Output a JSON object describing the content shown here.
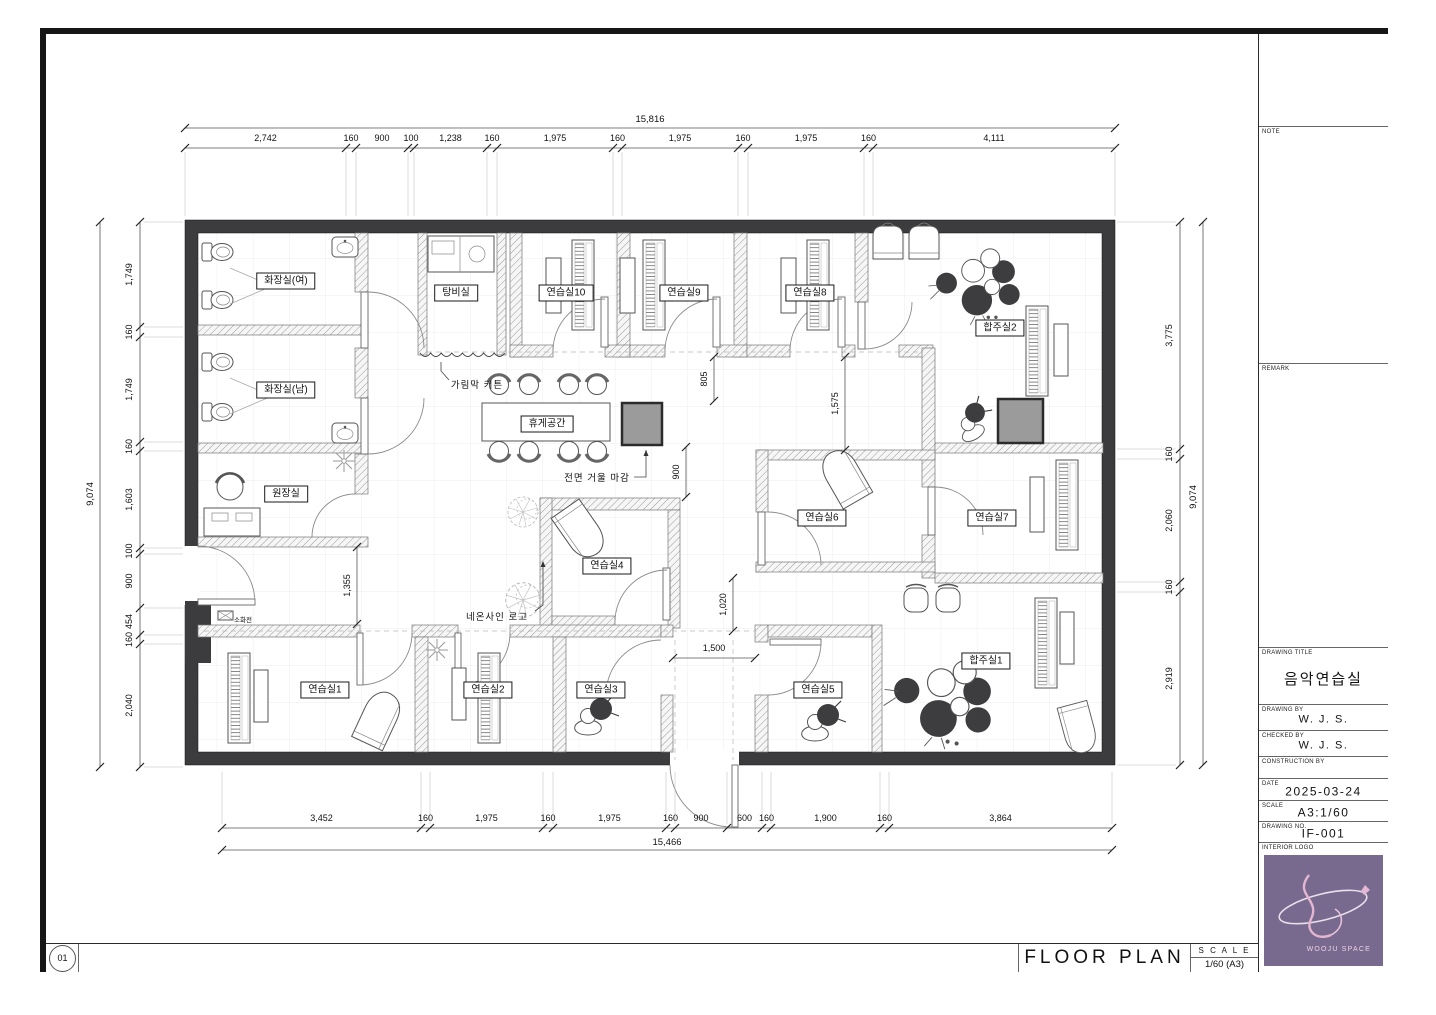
{
  "sheet": {
    "number": "01",
    "title": "FLOOR PLAN",
    "scale_heading": "S C A L E",
    "scale_value": "1/60 (A3)"
  },
  "title_block": {
    "note_label": "NOTE",
    "remark_label": "REMARK",
    "fields": [
      {
        "label": "DRAWING TITLE",
        "value": "음악연습실"
      },
      {
        "label": "DRAWING BY",
        "value": "W. J. S."
      },
      {
        "label": "CHECKED BY",
        "value": "W. J. S."
      },
      {
        "label": "CONSTRUCTION BY",
        "value": ""
      },
      {
        "label": "DATE",
        "value": "2025-03-24"
      },
      {
        "label": "SCALE",
        "value": "A3:1/60"
      },
      {
        "label": "DRAWING NO.",
        "value": "IF-001"
      }
    ],
    "interior_logo_label": "INTERIOR LOGO",
    "logo_text": "WOOJU SPACE",
    "logo_bg_color": "#786a8e"
  },
  "rooms": [
    {
      "id": "restroom-women",
      "label": "화장실(여)"
    },
    {
      "id": "restroom-men",
      "label": "화장실(남)"
    },
    {
      "id": "pantry",
      "label": "탕비실"
    },
    {
      "id": "practice-10",
      "label": "연습실10"
    },
    {
      "id": "practice-9",
      "label": "연습실9"
    },
    {
      "id": "practice-8",
      "label": "연습실8"
    },
    {
      "id": "ensemble-2",
      "label": "합주실2"
    },
    {
      "id": "lounge",
      "label": "휴게공간"
    },
    {
      "id": "director-office",
      "label": "원장실"
    },
    {
      "id": "practice-4",
      "label": "연습실4"
    },
    {
      "id": "practice-6",
      "label": "연습실6"
    },
    {
      "id": "practice-7",
      "label": "연습실7"
    },
    {
      "id": "practice-1",
      "label": "연습실1"
    },
    {
      "id": "practice-2",
      "label": "연습실2"
    },
    {
      "id": "practice-3",
      "label": "연습실3"
    },
    {
      "id": "practice-5",
      "label": "연습실5"
    },
    {
      "id": "ensemble-1",
      "label": "합주실1"
    }
  ],
  "annotations": {
    "curtain": "가림막 커튼",
    "mirror": "전면 거울 마감",
    "neon": "네온사인 로고",
    "hydrant": "소화전"
  },
  "dimensions": {
    "top": {
      "total": "15,816",
      "segments": [
        "2,742",
        "160",
        "900",
        "100",
        "1,238",
        "160",
        "1,975",
        "160",
        "1,975",
        "160",
        "1,975",
        "160",
        "4,111"
      ]
    },
    "bottom": {
      "total": "15,466",
      "segments": [
        "3,452",
        "160",
        "1,975",
        "160",
        "1,975",
        "160",
        "900",
        "600",
        "160",
        "1,900",
        "160",
        "3,864"
      ]
    },
    "left": {
      "total": "9,074",
      "segments": [
        "1,749",
        "160",
        "1,749",
        "160",
        "1,603",
        "100",
        "900",
        "454",
        "160",
        "2,040"
      ]
    },
    "right": {
      "total": "9,074",
      "segments": [
        "3,775",
        "160",
        "2,060",
        "160",
        "2,919"
      ]
    },
    "internal": [
      "805",
      "900",
      "1,575",
      "1,020",
      "1,355",
      "1,500"
    ]
  }
}
